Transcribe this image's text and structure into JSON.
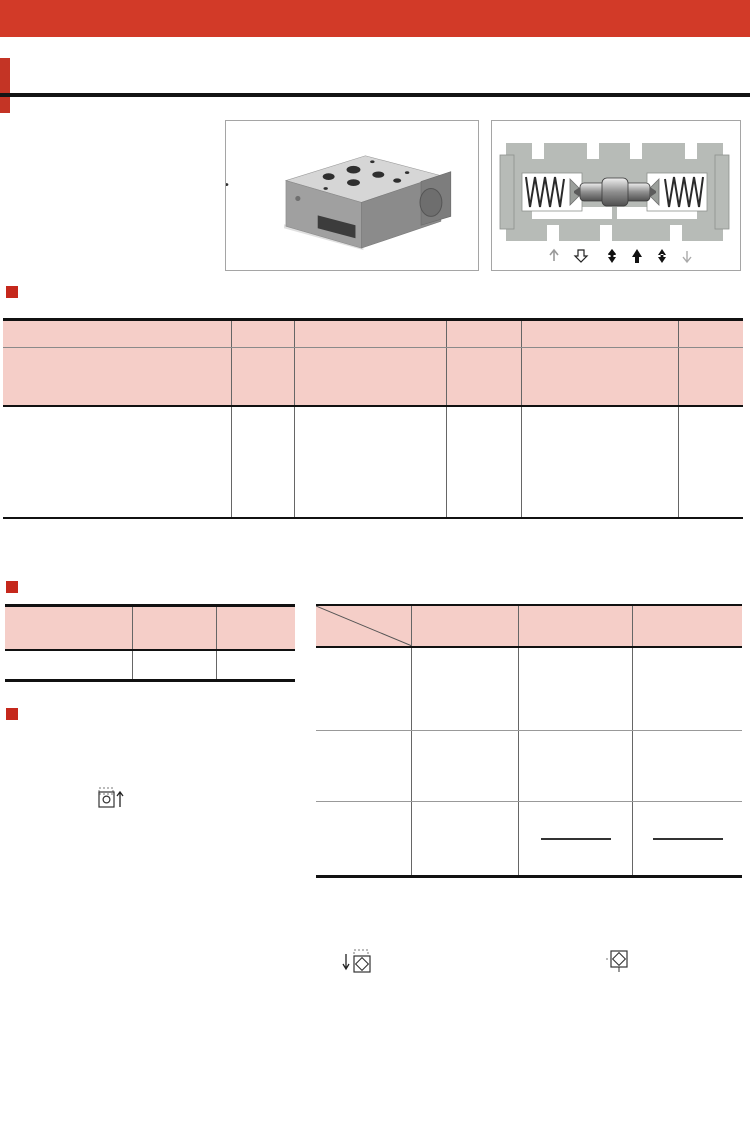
{
  "brand": {
    "logo": "YUKEN"
  },
  "watermark": {
    "text": "CCLair"
  },
  "header": {
    "title_cn": "叠加式液控单向阀",
    "title_en": "Pilot Operated Check Modular Valves"
  },
  "model_section": {
    "heading": "型号说明",
    "codes": [
      "MPA",
      "−06",
      "S",
      "−2",
      "−X",
      "−30"
    ],
    "descs": {
      "c1": "系列号",
      "c2": "规 格",
      "c3a": "控制口及泄油",
      "c3sup": "★1",
      "c3b": "口的螺纹类型",
      "c4a": "开启压力",
      "c4b": "MPa",
      "c5a": "开启压力控制",
      "c5sup": "★2",
      "c5b": "和泄油方式",
      "c6": "设计号"
    },
    "body": {
      "series_lines": [
        "MPA",
        "MPB",
        "MPW"
      ],
      "series_descs": [
        "：A油路用",
        "：B油路用",
        "：A·B油路用"
      ],
      "brace": "}",
      "series_note_l1": "叠加式液",
      "series_note_l2": "控单向阀",
      "size": "06",
      "threads": [
        "无标记：Rc⅜",
        "(老PT⅜)",
        "S ：G⅜",
        "(老PF⅜)"
      ],
      "pressures": [
        "2：0.2",
        "4：0.4"
      ],
      "controls": [
        "无标记：内控内泄",
        "X：外控外泄",
        "Y：外控内泄"
      ],
      "design": "30"
    },
    "notes": [
      {
        "star": "★1.",
        "text": "此项不适用于内控内泄型。"
      },
      {
        "star": "★2.",
        "text": "对MPW(A.B油路)型，仅有无标记：内控内泄型。"
      }
    ]
  },
  "params_section": {
    "heading": "参 数",
    "headers": {
      "model": "型 号",
      "pressure_l1": "最高工作压力",
      "pressure_l2": "MPa",
      "flow_l1": "最大流量",
      "flow_l2": "L/min"
    },
    "row": {
      "model": "MP※-06※-※-※-30",
      "pressure": "25",
      "flow": "500"
    }
  },
  "spec_section": {
    "heading": "特 性",
    "oil_note": "油液：粘度35mm²/s，比重0.850"
  },
  "jis_section": {
    "heading": "JIS液压图形符号",
    "corner_top": "控制泄油",
    "corner_top2": "方式",
    "corner_bottom": "型号",
    "col_headers": [
      "内控内泄型",
      "外控外泄型",
      "外控内泄型"
    ],
    "ports": [
      "P",
      "T",
      "Y",
      "X",
      "B",
      "A"
    ],
    "rows": [
      {
        "label": "MPA-06",
        "cells": [
          "MPA-06-※",
          "MPA-06※-※-X",
          "MPA-06※-※-Y"
        ]
      },
      {
        "label": "MPB-06",
        "cells": [
          "MPB-06-※",
          "MPB-06※-※-X",
          "MPB-06※-※-Y"
        ]
      },
      {
        "label": "MPW-06",
        "cells": [
          "MPW-06-※",
          "",
          ""
        ]
      }
    ]
  },
  "chart_data": [
    {
      "type": "line",
      "title": "反向流压降特性",
      "ylabel": "压降值",
      "ylabel2": "ΔP",
      "yunit": "MPa",
      "xlabel": "流 量 L/min",
      "xlim": [
        0,
        500
      ],
      "ylim": [
        0,
        2.5
      ],
      "xticks": [
        0,
        100,
        200,
        300,
        400,
        500
      ],
      "grid_x": [
        100,
        200,
        300,
        400
      ],
      "grid_y": [
        1.0,
        2.0
      ],
      "ytick_vals": [
        2.5,
        2.0,
        1.0
      ],
      "ytick_labels": [
        "2.5",
        "2.0",
        "1.0"
      ],
      "series": [
        {
          "name": "反向流压降",
          "points": [
            [
              0,
              0
            ],
            [
              50,
              0.03
            ],
            [
              100,
              0.09
            ],
            [
              150,
              0.21
            ],
            [
              200,
              0.37
            ],
            [
              250,
              0.58
            ],
            [
              300,
              0.83
            ],
            [
              350,
              1.12
            ],
            [
              400,
              1.46
            ],
            [
              450,
              1.82
            ],
            [
              500,
              2.2
            ]
          ]
        }
      ],
      "leaders": [],
      "annotations": []
    },
    {
      "type": "line",
      "title": "各油路压降特性",
      "ylabel": "压降值",
      "ylabel2": "ΔP",
      "yunit": "MPa",
      "xlabel": "流 量 L/min",
      "xlim": [
        0,
        500
      ],
      "ylim": [
        0,
        2.5
      ],
      "xticks": [
        0,
        100,
        200,
        300,
        400,
        500
      ],
      "grid_x": [
        100,
        200,
        300,
        400
      ],
      "grid_y": [
        1.0,
        2.0
      ],
      "ytick_vals": [
        2.5,
        2.0,
        1.0
      ],
      "ytick_labels": [
        "2.5",
        "2.0",
        "1.0"
      ],
      "series": [
        {
          "name": "MPA-06 B油路 / MPB-06 A油路",
          "points": [
            [
              0,
              0
            ],
            [
              50,
              0.03
            ],
            [
              100,
              0.09
            ],
            [
              150,
              0.21
            ],
            [
              200,
              0.37
            ],
            [
              250,
              0.58
            ],
            [
              300,
              0.83
            ],
            [
              350,
              1.12
            ],
            [
              400,
              1.46
            ],
            [
              450,
              1.82
            ],
            [
              500,
              2.2
            ]
          ]
        },
        {
          "name": "P,T油路",
          "points": [
            [
              0,
              0
            ],
            [
              100,
              0.03
            ],
            [
              200,
              0.09
            ],
            [
              300,
              0.17
            ],
            [
              400,
              0.29
            ],
            [
              500,
              0.45
            ]
          ]
        }
      ],
      "leaders": [
        [
          [
            0.5,
            0.3
          ],
          [
            0.655,
            0.575
          ]
        ],
        [
          [
            0.7,
            0.78
          ],
          [
            0.615,
            0.875
          ]
        ]
      ],
      "annotations": [
        "MPA-06：B油路",
        "MPB-06：A油路",
        "P, T油路"
      ]
    },
    {
      "type": "line",
      "title": "自由流压降特性",
      "ylabel": "压降值",
      "ylabel2": "ΔP",
      "yunit": "MPa",
      "xlabel": "流 量 L/min",
      "xlim": [
        0,
        500
      ],
      "ylim": [
        0,
        3.0
      ],
      "xticks": [
        0,
        100,
        200,
        300,
        400,
        500
      ],
      "grid_x": [
        100,
        200,
        300,
        400
      ],
      "grid_y": [
        1.0,
        2.0
      ],
      "ytick_vals": [
        3.0,
        2.0,
        1.0
      ],
      "ytick_labels": [
        "3.0",
        "2.0",
        "1.0"
      ],
      "series": [
        {
          "name": "MP※-06-4",
          "points": [
            [
              0,
              0.45
            ],
            [
              100,
              0.62
            ],
            [
              200,
              0.95
            ],
            [
              300,
              1.45
            ],
            [
              400,
              2.15
            ],
            [
              500,
              3.0
            ]
          ]
        },
        {
          "name": "MP※-06-2",
          "points": [
            [
              0,
              0.25
            ],
            [
              100,
              0.42
            ],
            [
              200,
              0.74
            ],
            [
              300,
              1.24
            ],
            [
              400,
              1.97
            ],
            [
              500,
              2.87
            ]
          ]
        }
      ],
      "leaders": [
        [
          [
            0.645,
            0.66
          ],
          [
            0.665,
            0.5
          ]
        ],
        [
          [
            0.56,
            0.82
          ],
          [
            0.585,
            0.635
          ]
        ]
      ],
      "annotations": [
        "MP※-06-4",
        "MP※-06-2"
      ]
    },
    {
      "type": "line",
      "title": "最低控制压力特性",
      "ylabel": "最低控制压力",
      "ylabel2": "(P.P)",
      "yunit": "MPa",
      "xlabel": "反向流入口压力（P2）",
      "xlabel2": "MPa",
      "xlim": [
        0,
        25
      ],
      "ylim": [
        0,
        4.5
      ],
      "xticks": [
        0,
        5,
        10,
        15,
        20,
        25
      ],
      "grid_x": [
        5,
        10,
        15,
        20
      ],
      "grid_y": [
        0.5,
        1.0,
        1.5,
        2.0,
        2.5,
        3.0,
        3.5,
        4.0
      ],
      "ytick_vals": [
        4.5,
        4.0,
        3.5,
        3.0,
        2.5,
        2.0,
        1.5,
        1.0,
        0.5
      ],
      "ytick_labels": [
        "4.5",
        "4.0",
        "3.5",
        "3.0",
        "2.5",
        "2.0",
        "1.5",
        "1.0",
        "0.5"
      ],
      "series": [
        {
          "name": "MP※-06-4",
          "points": [
            [
              0,
              0.6
            ],
            [
              25,
              4.3
            ]
          ]
        },
        {
          "name": "MP※-06-2",
          "points": [
            [
              0,
              0.38
            ],
            [
              25,
              4.05
            ]
          ]
        }
      ],
      "leaders": [
        [
          [
            0.585,
            0.7
          ],
          [
            0.455,
            0.52
          ]
        ],
        [
          [
            0.585,
            0.84
          ],
          [
            0.4,
            0.625
          ]
        ]
      ],
      "annotations": [
        "MP※-06-4",
        "MP※-06-2"
      ],
      "inset": {
        "pp": "P.P",
        "p1": "P1",
        "p2": "P2"
      }
    }
  ]
}
